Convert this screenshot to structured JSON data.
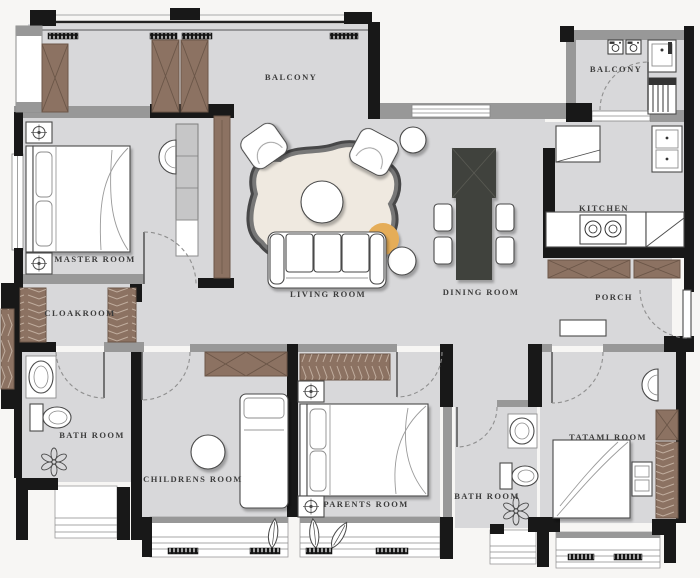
{
  "plan": {
    "title": "apartment floor plan",
    "rooms": {
      "balcony_main": {
        "label": "BALCONY"
      },
      "balcony_laundry": {
        "label": "BALCONY"
      },
      "master": {
        "label": "MASTER ROOM"
      },
      "cloakroom": {
        "label": "CLOAKROOM"
      },
      "living": {
        "label": "LIVING ROOM"
      },
      "dining": {
        "label": "DINING ROOM"
      },
      "kitchen": {
        "label": "KITCHEN"
      },
      "porch": {
        "label": "PORCH"
      },
      "bath_left": {
        "label": "BATH ROOM"
      },
      "children": {
        "label": "CHILDRENS ROOM"
      },
      "parents": {
        "label": "PARENTS ROOM"
      },
      "bath_right": {
        "label": "BATH ROOM"
      },
      "tatami": {
        "label": "TATAMI ROOM"
      }
    },
    "colors": {
      "background": "#f7f6f4",
      "floor": "#d8d8da",
      "floor_warm": "#efe9e0",
      "wall": "#181818",
      "wall_gray": "#989898",
      "wood": "#8c7262",
      "wood_dark": "#6b5648",
      "furniture_dark": "#41423c",
      "accent_ottoman": "#e5ad58",
      "line": "#4a4a4a",
      "label_text": "#3c3c3c"
    }
  }
}
